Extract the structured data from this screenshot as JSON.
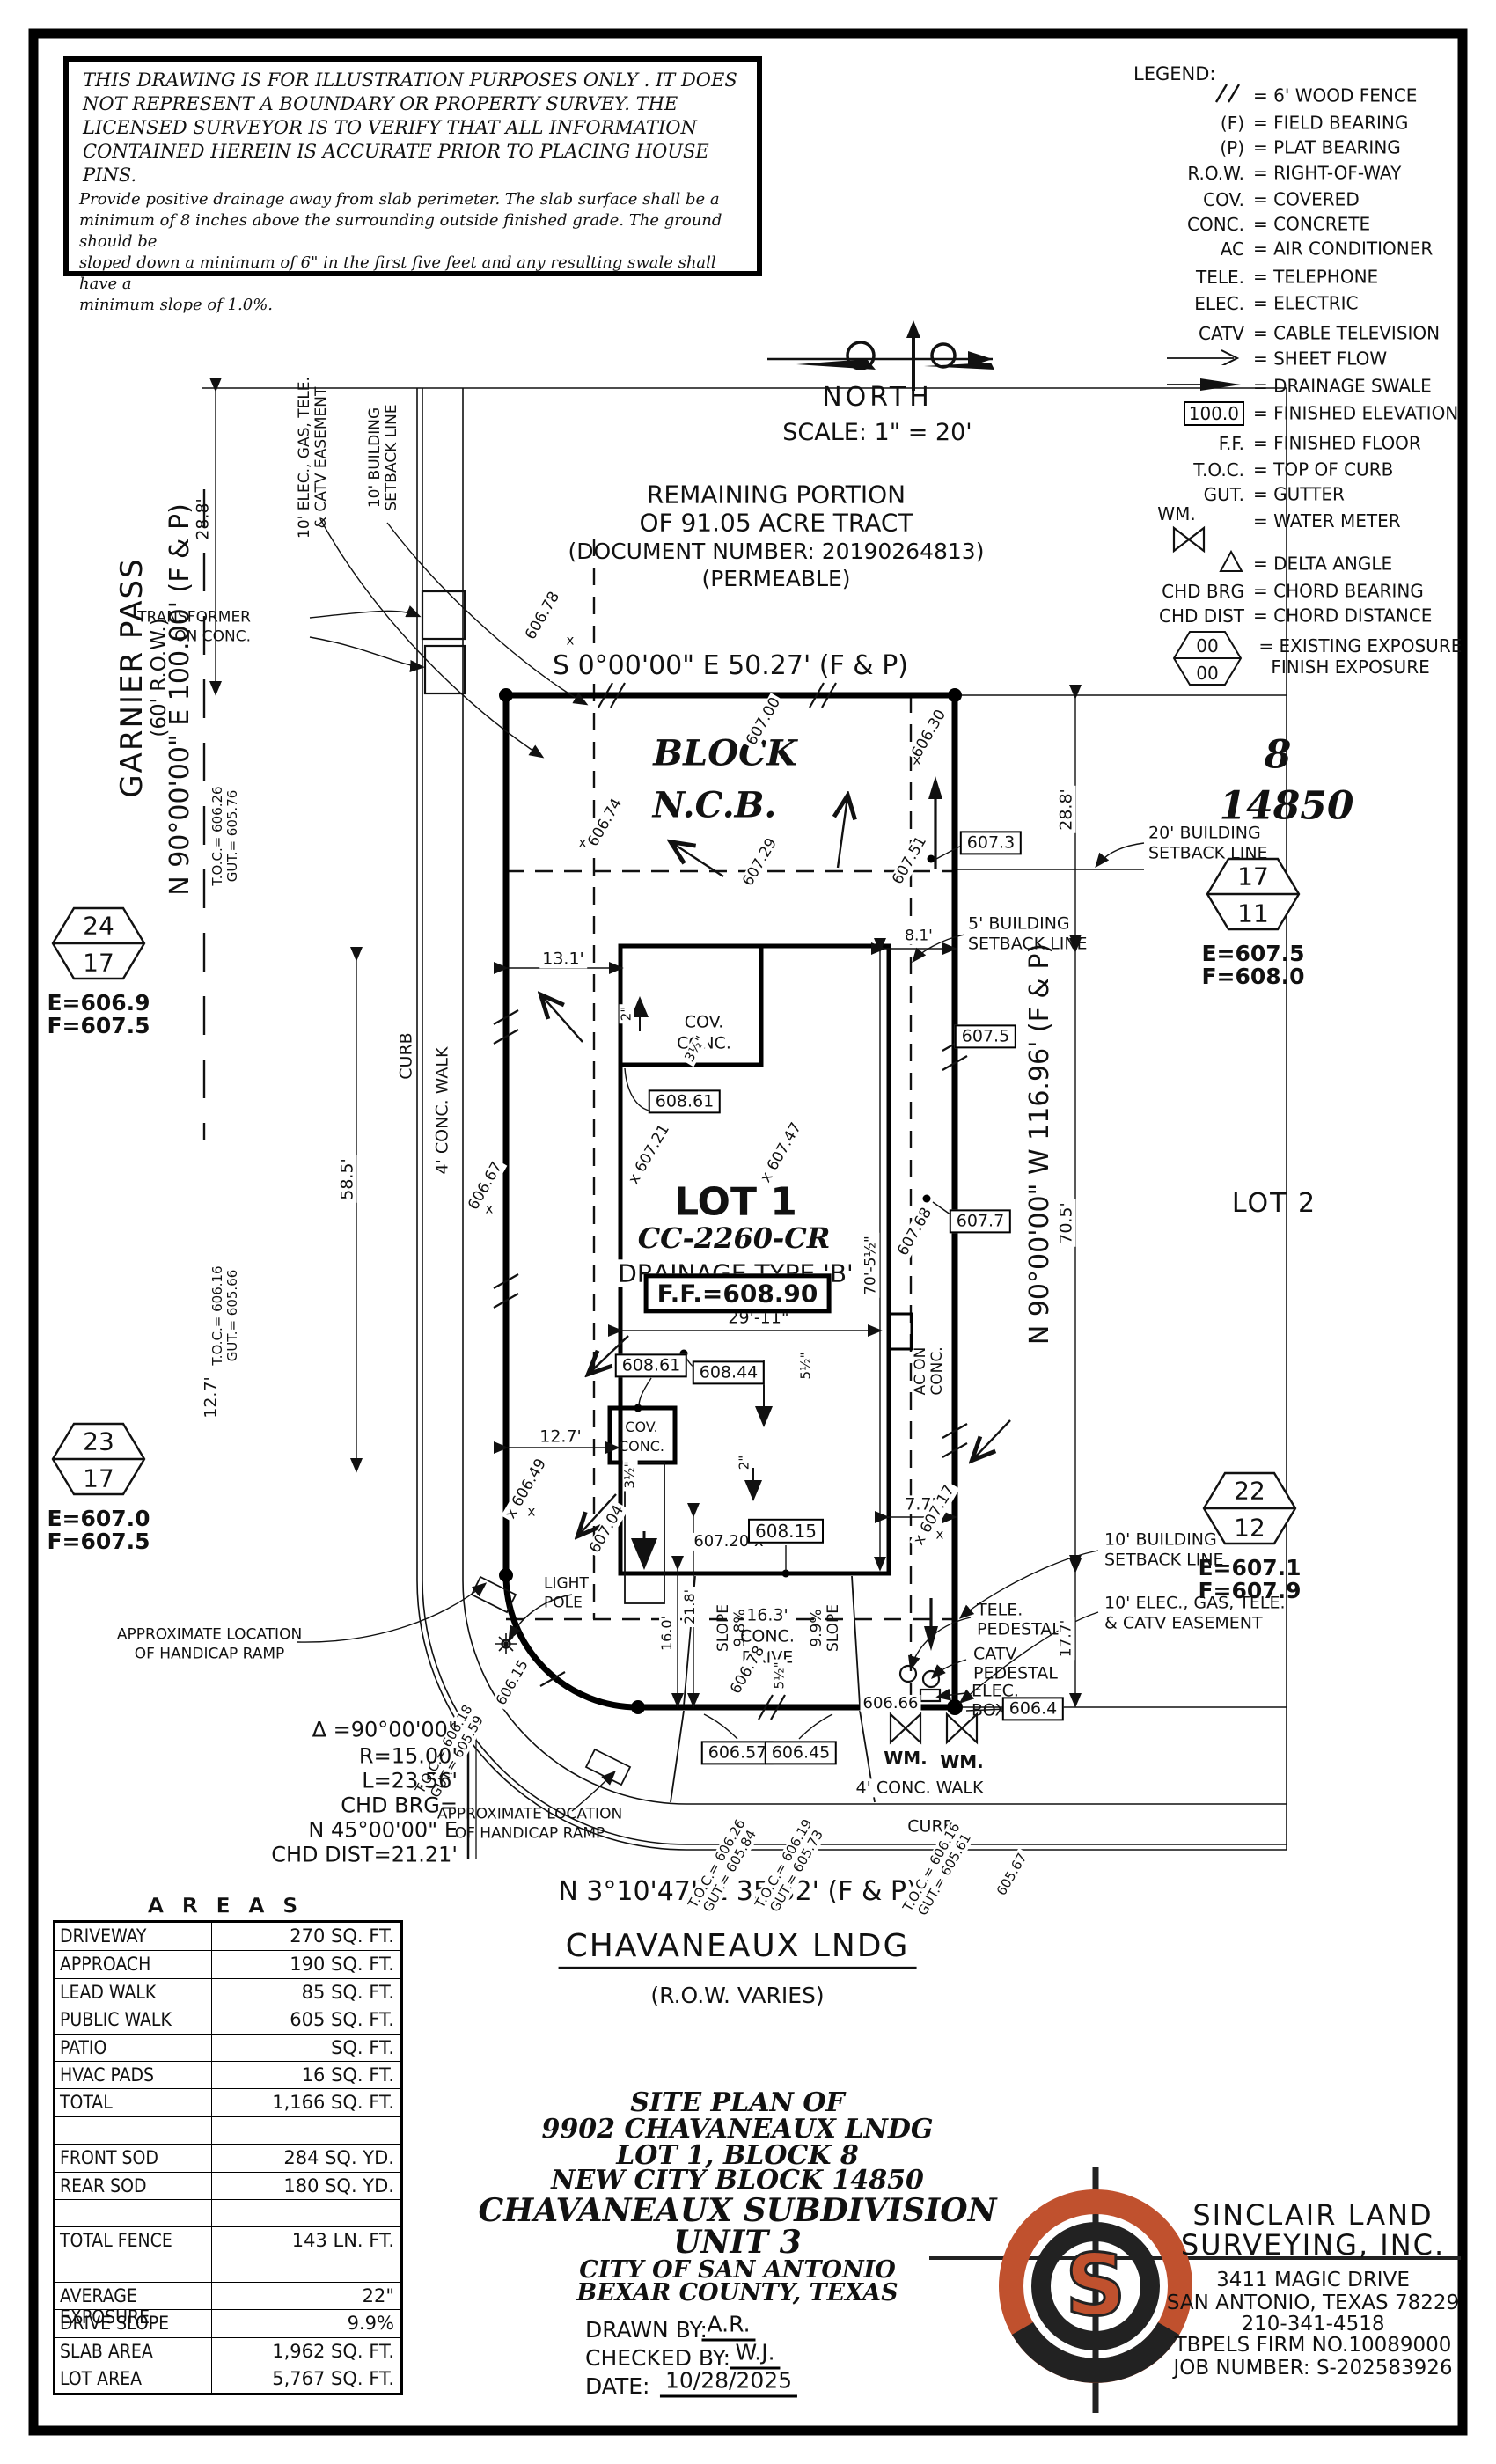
{
  "colors": {
    "accent": "#c0512e",
    "ink": "#111111"
  },
  "disclaimer": {
    "caps": [
      "THIS DRAWING IS FOR ILLUSTRATION PURPOSES ONLY . IT DOES",
      "NOT REPRESENT A BOUNDARY OR PROPERTY SURVEY. THE",
      "LICENSED SURVEYOR IS TO VERIFY THAT ALL INFORMATION",
      "CONTAINED HEREIN IS ACCURATE PRIOR TO PLACING HOUSE PINS."
    ],
    "notes": [
      "Provide positive drainage away from slab perimeter. The slab surface shall be a",
      "minimum of 8 inches above the surrounding outside finished grade. The ground should be",
      "sloped down a minimum of 6\" in the first five feet and any resulting swale shall have a",
      "minimum slope of 1.0%."
    ]
  },
  "compass": {
    "label": "NORTH",
    "scale": "SCALE: 1\" = 20'"
  },
  "legend": {
    "title": "LEGEND:",
    "rows": [
      {
        "key": "",
        "text": "= 6' WOOD FENCE"
      },
      {
        "key": "(F)",
        "text": "= FIELD BEARING"
      },
      {
        "key": "(P)",
        "text": "= PLAT BEARING"
      },
      {
        "key": "R.O.W.",
        "text": "= RIGHT-OF-WAY"
      },
      {
        "key": "COV.",
        "text": "= COVERED"
      },
      {
        "key": "CONC.",
        "text": "= CONCRETE"
      },
      {
        "key": "AC",
        "text": "= AIR CONDITIONER"
      },
      {
        "key": "TELE.",
        "text": "= TELEPHONE"
      },
      {
        "key": "ELEC.",
        "text": "= ELECTRIC"
      },
      {
        "key": "CATV",
        "text": "= CABLE TELEVISION"
      },
      {
        "key": "",
        "text": "= SHEET FLOW"
      },
      {
        "key": "",
        "text": "= DRAINAGE SWALE"
      },
      {
        "key": "100.0",
        "text": "= FINISHED ELEVATION"
      },
      {
        "key": "F.F.",
        "text": "= FINISHED FLOOR"
      },
      {
        "key": "T.O.C.",
        "text": "= TOP OF CURB"
      },
      {
        "key": "GUT.",
        "text": "= GUTTER"
      },
      {
        "key": "WM.",
        "text": "= WATER METER"
      },
      {
        "key": "",
        "text": "= DELTA ANGLE"
      },
      {
        "key": "CHD BRG",
        "text": "= CHORD BEARING"
      },
      {
        "key": "CHD DIST",
        "text": "= CHORD DISTANCE"
      }
    ],
    "exposure": {
      "top": "00",
      "bottom": "00",
      "line1": "= EXISTING EXPOSURE",
      "line2": "FINISH EXPOSURE"
    }
  },
  "plan": {
    "tract": [
      "REMAINING PORTION",
      "OF 91.05 ACRE TRACT",
      "(DOCUMENT NUMBER: 20190264813)",
      "(PERMEABLE)"
    ],
    "bearing_top": "S 0°00'00\" E 50.27' (F & P)",
    "bearing_left": "N 90°00'00\" E 100.00' (F & P)",
    "bearing_right": "N 90°00'00\" W 116.96' (F & P)",
    "bearing_bottom": "N 3°10'47\" E 35.32' (F & P)",
    "street_left": {
      "name": "GARNIER PASS",
      "row": "(60' R.O.W.)"
    },
    "street_bottom": {
      "name": "CHAVANEAUX LNDG",
      "row": "(R.O.W. VARIES)"
    },
    "block_label": "BLOCK",
    "ncb_label": "N.C.B.",
    "block_num": "8",
    "ncb_num": "14850",
    "lot1": "LOT 1",
    "cc": "CC-2260-CR",
    "drainage": "DRAINAGE TYPE 'B'",
    "ff": "F.F.=608.90",
    "lot2": "LOT 2",
    "transformer": [
      "TRANSFORMER",
      "ON CONC."
    ],
    "setback20": [
      "20' BUILDING",
      "SETBACK LINE"
    ],
    "setback5": [
      "5' BUILDING",
      "SETBACK LINE"
    ],
    "setback10": [
      "10' BUILDING",
      "SETBACK LINE"
    ],
    "easement10": [
      "10' ELEC., GAS, TELE.",
      "& CATV EASEMENT"
    ],
    "handicap": [
      "APPROXIMATE LOCATION",
      "OF HANDICAP RAMP"
    ],
    "light_pole": [
      "LIGHT",
      "POLE"
    ],
    "tele_ped": [
      "TELE.",
      "PEDESTAL"
    ],
    "catv_ped": [
      "CATV",
      "PEDESTAL"
    ],
    "elec_box": [
      "ELEC.",
      "BOX"
    ],
    "ac": [
      "AC ON",
      "CONC."
    ],
    "cov": [
      "COV.",
      "CONC."
    ],
    "walk4": "4' CONC. WALK",
    "curb": "CURB",
    "drive": [
      "16.3'",
      "CONC.",
      "DRIVE"
    ],
    "slope_word": "SLOPE",
    "slope98": "9.8%",
    "slope99": "9.9%",
    "wm": "WM.",
    "x": "x",
    "dims": {
      "d28l": "28.8'",
      "d28r": "28.8'",
      "d131": "13.1'",
      "d81": "8.1'",
      "d585": "58.5'",
      "d705": "70.5'",
      "d127v": "12.7'",
      "d127h": "12.7'",
      "d2911": "29'-11\"",
      "d7051": "70'-5½\"",
      "d77": "7.7'",
      "d177": "17.7'",
      "d160": "16.0'",
      "d218": "21.8'",
      "in2a": "2\"",
      "in2b": "2\"",
      "in35a": "3½\"",
      "in35b": "3½\"",
      "in55a": "5½\"",
      "in55b": "5½\""
    },
    "boxed": {
      "b1": "607.3",
      "b2": "607.5",
      "b3": "607.7",
      "b4": "608.61",
      "b5": "608.61",
      "b6": "608.44",
      "b7": "608.15",
      "b8": "606.4",
      "b9": "606.57",
      "b10": "606.45"
    },
    "spots": {
      "s1": "606.78",
      "s2": "607.00",
      "s3": "606.30",
      "s4": "607.51",
      "s5": "606.74",
      "s6": "607.29",
      "s7": "x 607.21",
      "s8": "x 607.47",
      "s9": "607.68",
      "s10": "606.67",
      "s11": "x 606.49",
      "s12": "607.04",
      "s13": "x 607.17",
      "s14": "606.78",
      "s15": "606.66",
      "s16": "607.20 x",
      "s17": "606.15",
      "s18": "605.67"
    },
    "tocgut": [
      [
        "T.O.C.= 606.26",
        "GUT.= 605.76"
      ],
      [
        "T.O.C.= 606.16",
        "GUT.= 605.66"
      ],
      [
        "T.O.C.= 606.18",
        "GUT.= 605.59"
      ],
      [
        "T.O.C.= 606.26",
        "GUT.= 605.84"
      ],
      [
        "T.O.C.= 606.19",
        "GUT.= 605.73"
      ],
      [
        "T.O.C.= 606.16",
        "GUT.= 605.61"
      ]
    ],
    "curve": [
      "Δ =90°00'00\"",
      "R=15.00'",
      "L=23.56'",
      "CHD BRG=",
      "N 45°00'00\" E",
      "CHD DIST=21.21'"
    ],
    "hex": [
      {
        "a": "24",
        "b": "17",
        "e": "E=606.9",
        "f": "F=607.5"
      },
      {
        "a": "23",
        "b": "17",
        "e": "E=607.0",
        "f": "F=607.5"
      },
      {
        "a": "17",
        "b": "11",
        "e": "E=607.5",
        "f": "F=608.0"
      },
      {
        "a": "22",
        "b": "12",
        "e": "E=607.1",
        "f": "F=607.9"
      }
    ]
  },
  "areas": {
    "title": "A R E A S",
    "rows": [
      [
        "DRIVEWAY",
        "270 SQ. FT."
      ],
      [
        "APPROACH",
        "190 SQ. FT."
      ],
      [
        "LEAD WALK",
        "85 SQ. FT."
      ],
      [
        "PUBLIC WALK",
        "605 SQ. FT."
      ],
      [
        "PATIO",
        "SQ. FT."
      ],
      [
        "HVAC PADS",
        "16 SQ. FT."
      ],
      [
        "TOTAL",
        "1,166 SQ. FT."
      ],
      [
        "",
        ""
      ],
      [
        "FRONT SOD",
        "284 SQ. YD."
      ],
      [
        "REAR SOD",
        "180 SQ. YD."
      ],
      [
        "",
        ""
      ],
      [
        "TOTAL FENCE",
        "143 LN. FT."
      ],
      [
        "",
        ""
      ],
      [
        "AVERAGE EXPOSURE",
        "22\""
      ],
      [
        "DRIVE SLOPE",
        "9.9%"
      ],
      [
        "SLAB AREA",
        "1,962 SQ. FT."
      ],
      [
        "LOT AREA",
        "5,767 SQ. FT."
      ]
    ]
  },
  "title_block": {
    "lines": [
      "SITE PLAN OF",
      "9902 CHAVANEAUX LNDG",
      "LOT 1, BLOCK 8",
      "NEW CITY BLOCK 14850",
      "CHAVANEAUX SUBDIVISION",
      "UNIT 3",
      "CITY OF SAN ANTONIO",
      "BEXAR COUNTY, TEXAS"
    ],
    "drawn_label": "DRAWN BY:",
    "drawn": "A.R.",
    "checked_label": "CHECKED BY:",
    "checked": "W.J.",
    "date_label": "DATE:",
    "date": "10/28/2025"
  },
  "firm": {
    "logo_letter": "S",
    "name1": "SINCLAIR LAND",
    "name2": "SURVEYING, INC.",
    "addr1": "3411 MAGIC DRIVE",
    "addr2": "SAN ANTONIO, TEXAS 78229",
    "phone": "210-341-4518",
    "firm_no": "TBPELS FIRM NO.10089000",
    "job": "JOB NUMBER: S-202583926"
  }
}
